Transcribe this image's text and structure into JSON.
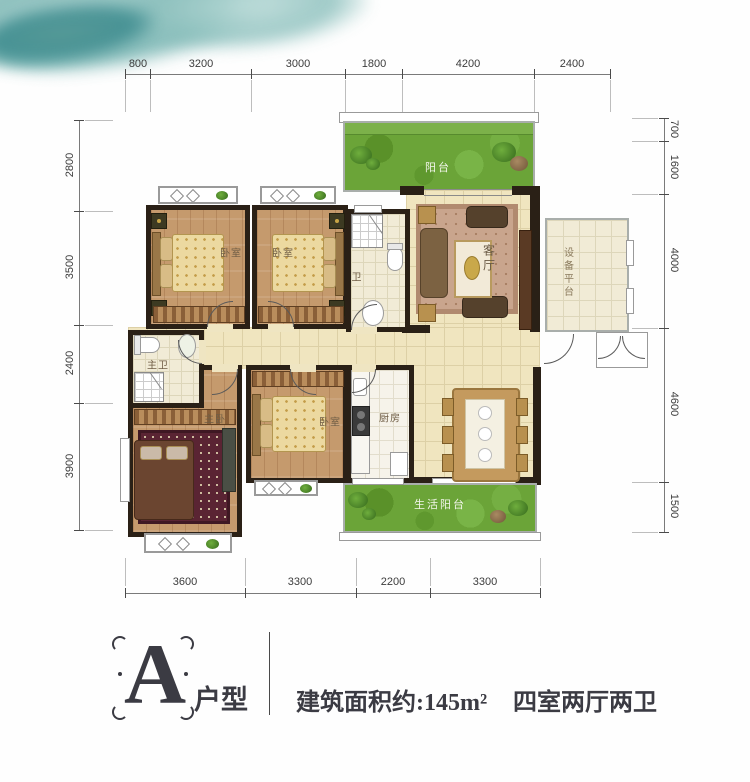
{
  "plan": {
    "rooms": {
      "bedroom_top_left": "卧室",
      "bedroom_top_mid": "卧室",
      "bathroom": "卫",
      "living_room": "客厅",
      "balcony": "阳台",
      "equipment_platform": "设备平台",
      "master_bathroom": "主卫",
      "master_bedroom": "主卧",
      "bedroom_mid": "卧室",
      "kitchen": "厨房",
      "service_balcony": "生活阳台"
    },
    "dimensions": {
      "top": [
        "800",
        "3200",
        "3000",
        "1800",
        "4200",
        "2400"
      ],
      "left": [
        "2800",
        "3500",
        "2400",
        "3900"
      ],
      "right": [
        "700",
        "1600",
        "4000",
        "4600",
        "1500"
      ],
      "bottom": [
        "3600",
        "3300",
        "2200",
        "3300"
      ]
    }
  },
  "footer": {
    "unit_letter": "A",
    "unit_label": "户型",
    "area_text": "建筑面积约:145m²",
    "layout_text": "四室两厅两卫"
  },
  "colors": {
    "wall": "#2a2016",
    "wood_floor": "#c59a6d",
    "tile_floor": "#f0e5bf",
    "balcony_green": "#6ba438",
    "watercolor_teal": "#5fa3a1",
    "footer_text": "#3b3b43"
  }
}
